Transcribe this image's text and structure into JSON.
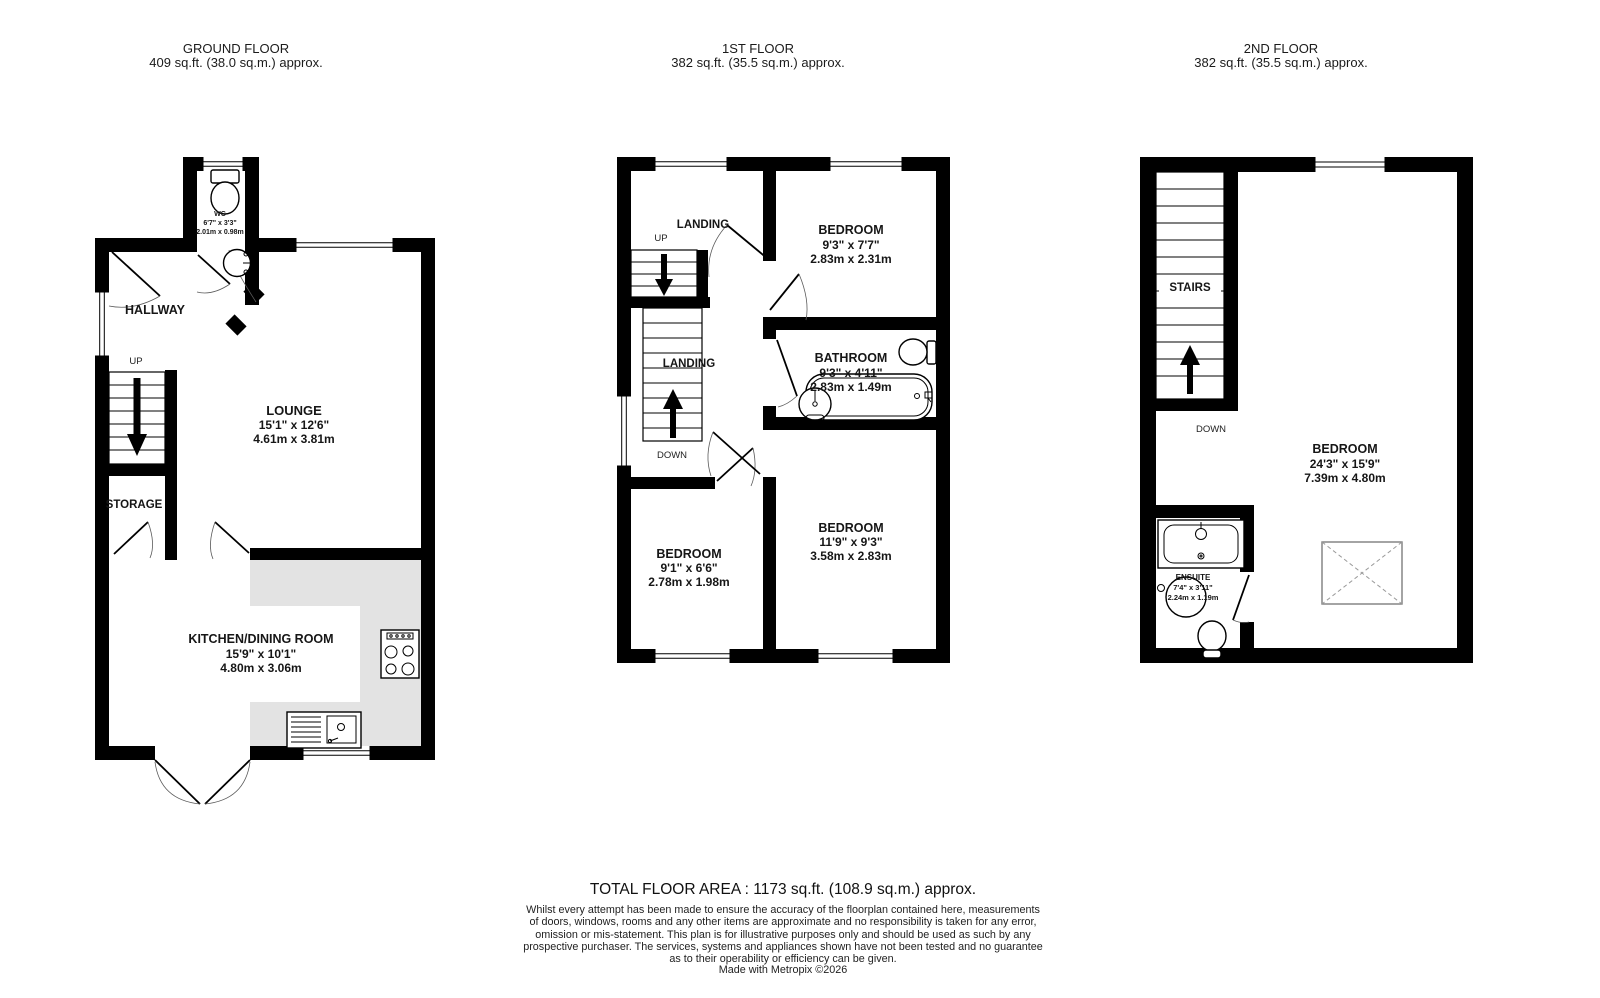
{
  "page": {
    "background": "#ffffff",
    "wall_color": "#000000",
    "counter_color": "#e3e3e3"
  },
  "floors": [
    {
      "title": "GROUND FLOOR",
      "area": "409 sq.ft. (38.0 sq.m.) approx.",
      "rooms": [
        {
          "name": "WC",
          "imperial": "6'7\" x 3'3\"",
          "metric": "2.01m x 0.98m"
        },
        {
          "name": "HALLWAY"
        },
        {
          "name": "LOUNGE",
          "imperial": "15'1\" x 12'6\"",
          "metric": "4.61m x 3.81m"
        },
        {
          "name": "STORAGE"
        },
        {
          "name": "KITCHEN/DINING ROOM",
          "imperial": "15'9\" x 10'1\"",
          "metric": "4.80m x 3.06m"
        }
      ],
      "stair_labels": {
        "up": "UP"
      }
    },
    {
      "title": "1ST FLOOR",
      "area": "382 sq.ft. (35.5 sq.m.) approx.",
      "rooms": [
        {
          "name": "LANDING"
        },
        {
          "name": "BEDROOM",
          "imperial": "9'3\" x 7'7\"",
          "metric": "2.83m x 2.31m"
        },
        {
          "name": "LANDING"
        },
        {
          "name": "BATHROOM",
          "imperial": "9'3\" x 4'11\"",
          "metric": "2.83m x 1.49m"
        },
        {
          "name": "BEDROOM",
          "imperial": "9'1\" x 6'6\"",
          "metric": "2.78m x 1.98m"
        },
        {
          "name": "BEDROOM",
          "imperial": "11'9\" x 9'3\"",
          "metric": "3.58m x 2.83m"
        }
      ],
      "stair_labels": {
        "up": "UP",
        "down": "DOWN"
      }
    },
    {
      "title": "2ND FLOOR",
      "area": "382 sq.ft. (35.5 sq.m.) approx.",
      "rooms": [
        {
          "name": "STAIRS"
        },
        {
          "name": "BEDROOM",
          "imperial": "24'3\" x 15'9\"",
          "metric": "7.39m x 4.80m"
        },
        {
          "name": "ENSUITE",
          "imperial": "7'4\" x 3'11\"",
          "metric": "2.24m x 1.19m"
        }
      ],
      "stair_labels": {
        "down": "DOWN"
      }
    }
  ],
  "footer": {
    "total_area": "TOTAL FLOOR AREA : 1173 sq.ft. (108.9 sq.m.) approx.",
    "disclaimer_lines": [
      "Whilst every attempt has been made to ensure the accuracy of the floorplan contained here, measurements",
      "of doors, windows, rooms and any other items are approximate and no responsibility is taken for any error,",
      "omission or mis-statement. This plan is for illustrative purposes only and should be used as such by any",
      "prospective purchaser. The services, systems and appliances shown have not been tested and no guarantee",
      "as to their operability or efficiency can be given."
    ],
    "credit": "Made with Metropix ©2026"
  }
}
